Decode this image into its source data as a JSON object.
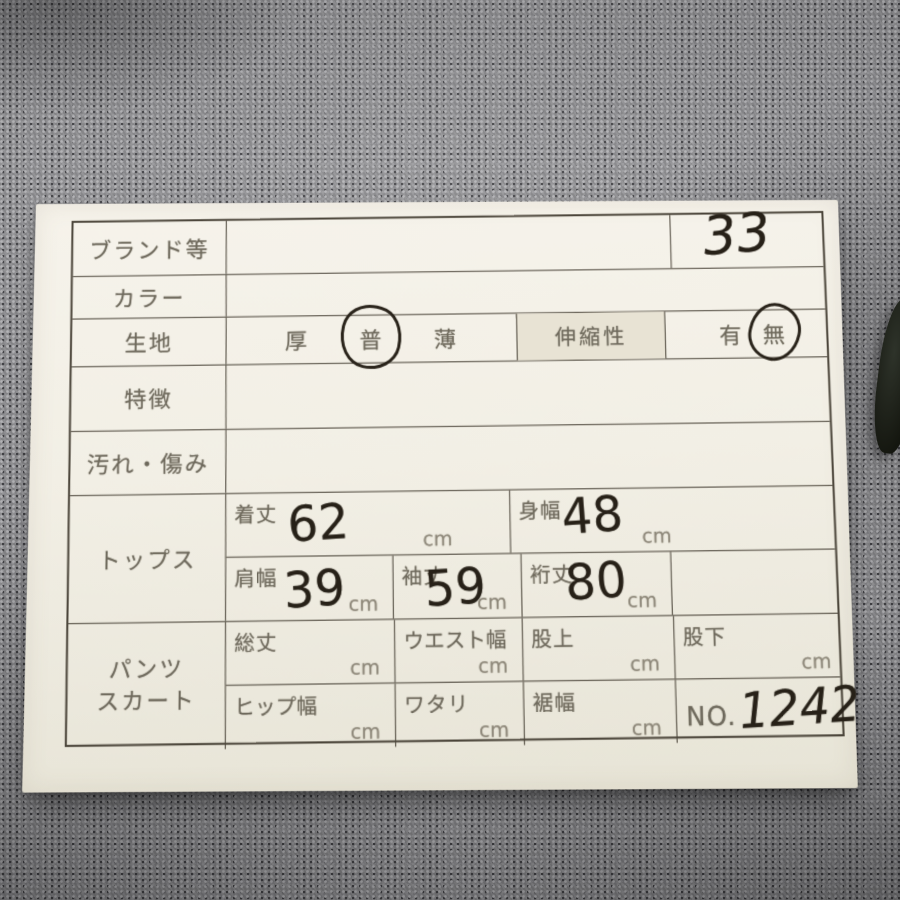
{
  "card": {
    "rows": {
      "brand": {
        "label": "ブランド等",
        "value": "",
        "number": "33"
      },
      "color": {
        "label": "カラー",
        "value": ""
      },
      "fabric": {
        "label": "生地",
        "thickness_options": [
          "厚",
          "普",
          "薄"
        ],
        "selected_thickness": "普",
        "stretch_label": "伸縮性",
        "stretch_options": [
          "有",
          "無"
        ],
        "selected_stretch": "無"
      },
      "features": {
        "label": "特徴",
        "value": ""
      },
      "damage": {
        "label": "汚れ・傷み",
        "value": ""
      },
      "tops": {
        "label": "トップス",
        "measurements": [
          {
            "name": "着丈",
            "value": "62",
            "unit": "cm"
          },
          {
            "name": "身幅",
            "value": "48",
            "unit": "cm"
          },
          {
            "name": "肩幅",
            "value": "39",
            "unit": "cm"
          },
          {
            "name": "袖丈",
            "value": "59",
            "unit": "cm"
          },
          {
            "name": "裄丈",
            "value": "80",
            "unit": "cm"
          }
        ]
      },
      "bottoms": {
        "label_line1": "パンツ",
        "label_line2": "スカート",
        "measurements": [
          {
            "name": "総丈",
            "value": "",
            "unit": "cm"
          },
          {
            "name": "ウエスト幅",
            "value": "",
            "unit": "cm"
          },
          {
            "name": "股上",
            "value": "",
            "unit": "cm"
          },
          {
            "name": "股下",
            "value": "",
            "unit": "cm"
          },
          {
            "name": "ヒップ幅",
            "value": "",
            "unit": "cm"
          },
          {
            "name": "ワタリ",
            "value": "",
            "unit": "cm"
          },
          {
            "name": "裾幅",
            "value": "",
            "unit": "cm"
          }
        ],
        "no_label": "NO.",
        "no_value": "1242"
      }
    },
    "colors": {
      "fabric_background": "#8a8a8d",
      "paper": "#f2efe5",
      "table_line": "#4b453a",
      "printed_text": "#6e695c",
      "handwriting": "#272118",
      "shaded_cell": "#e8e3d4"
    }
  }
}
